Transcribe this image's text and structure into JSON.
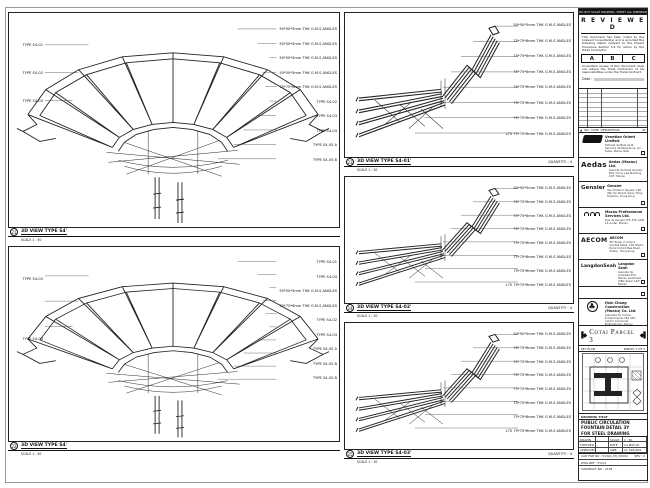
{
  "panels": {
    "tl": {
      "num": "21",
      "title": "3D VIEW TYPE S4'",
      "scale": "SCALE 1 : 50",
      "left_labels": [
        "TYPE S4-01",
        "TYPE S4-02",
        "TYPE S4-03"
      ],
      "right_labels": [
        "50*50*5mm THK G.M.S ANGLES",
        "50*50*5mm THK G.M.S ANGLES",
        "50*50*5mm THK G.M.S ANGLES",
        "50*50*5mm THK G.M.S ANGLES",
        "75*75*6mm THK G.M.S ANGLES",
        "TYPE S4-02",
        "TYPE S4-03",
        "TYPE S4-04",
        "TYPE S4-05 A",
        "TYPE S4-05 B"
      ]
    },
    "bl": {
      "num": "22",
      "title": "3D VIEW TYPE S4'",
      "scale": "SCALE 1 : 50",
      "left_labels": [
        "TYPE S4-02",
        "TYPE S4-03"
      ],
      "right_labels": [
        "TYPE S4-01",
        "TYPE S4-04",
        "50*50*5mm THK G.M.S ANGLES",
        "75*75*6mm THK G.M.S ANGLES",
        "TYPE S4-02",
        "TYPE S4-04",
        "TYPE S4-05 A",
        "TYPE S4-05 B",
        "TYPE S4-05 B"
      ]
    },
    "m1": {
      "num": "23",
      "title": "3D VIEW TYPE S4-01'",
      "scale": "SCALE 1 : 20",
      "quantity": "QUANTITY : 4",
      "right_labels": [
        "50*50*5mm THK G.M.S ANGLES",
        "75*75*6mm THK G.M.S ANGLES",
        "75*75*6mm THK G.M.S ANGLES",
        "75*75*6mm THK G.M.S ANGLES",
        "75*75*6mm THK G.M.S ANGLES",
        "75*75*6mm THK G.M.S ANGLES",
        "75*75*6mm THK G.M.S ANGLES",
        "L75 75*75*6mm THK G.M.S ANGLES"
      ]
    },
    "m2": {
      "num": "24",
      "title": "3D VIEW TYPE S4-02'",
      "scale": "SCALE 1 : 20",
      "quantity": "QUANTITY : 4",
      "right_labels": [
        "50*50*5mm THK G.M.S ANGLES",
        "75*75*6mm THK G.M.S ANGLES",
        "75*75*6mm THK G.M.S ANGLES",
        "75*75*6mm THK G.M.S ANGLES",
        "75*75*6mm THK G.M.S ANGLES",
        "75*75*6mm THK G.M.S ANGLES",
        "75*75*6mm THK G.M.S ANGLES",
        "L75 75*75*6mm THK G.M.S ANGLES"
      ]
    },
    "m3": {
      "num": "25",
      "title": "3D VIEW TYPE S4-03'",
      "scale": "SCALE 1 : 20",
      "quantity": "QUANTITY : 4",
      "right_labels": [
        "50*50*5mm THK G.M.S ANGLES",
        "75*75*6mm THK G.M.S ANGLES",
        "75*75*6mm THK G.M.S ANGLES",
        "75*75*6mm THK G.M.S ANGLES",
        "75*75*6mm THK G.M.S ANGLES",
        "75*75*6mm THK G.M.S ANGLES",
        "75*75*6mm THK G.M.S ANGLES",
        "L75 75*75*6mm THK G.M.S ANGLES"
      ]
    }
  },
  "titleblock": {
    "top_note": "DO NOT SCALE DRAWING. VERIFY ALL DIMENSIONS ON SITE.",
    "reviewed": {
      "title": "R E V I E W E D",
      "para1": "This document has been noted by the relevant Consultant(s) and is accorded the following status relevant to the Project Procedure Section 5.4 for action by the Trade Contractor.",
      "cols": [
        "A",
        "B",
        "C"
      ],
      "para2": "Consultant review of this document does not relieve the Trade Contractor of his responsibilities under the Trade Contract.",
      "date_label": "Date :"
    },
    "revision": {
      "headers": [
        "NO.",
        "DATE",
        "DESCRIPTION",
        "BY"
      ]
    },
    "companies": [
      {
        "name": "Venetian Orient Limited",
        "lines": "Estrada da Baia de N. Senhora da Esperanca, s/n, Taipa, Macau SAR"
      },
      {
        "logo": "Aedas",
        "name": "Aedas (Macau) Ltd.",
        "lines": "Avenida da Praia Grande 409, China Law Building 21/F, Macau"
      },
      {
        "logo": "Gensler",
        "name": "Gensler",
        "lines": "Two Harbour Square, 180 Wai Yip Street, Kwun Tong, Kowloon, Hong Kong"
      },
      {
        "name": "Macau Professional Services Ltd.",
        "lines": "Rua de Xangai 175, Edf. ACM 14 Andar, Macau"
      },
      {
        "logo": "AECOM",
        "name": "AECOM",
        "lines": "8/F Tower 2, Grand Central Plaza, 138 Shatin Rural Committee Road, Shatin, Hong Kong"
      },
      {
        "logo": "LangdonSeah",
        "name": "Langdon Seah",
        "lines": "Avenida da Amizade 555, Macau Landmark ICBC Tower 12/F, Macau"
      }
    ],
    "contractor": {
      "name": "Hsin Chong Construction (Macau) Co. Ltd.",
      "lines": "Alameda Dr. Carlos D'Assumpcao 181-187, Centro Comercial Brilhantismo, Macau"
    },
    "banner": {
      "text": "Cotai Parcel 3"
    },
    "keyplan": {
      "label": "KEY PLAN",
      "sheet": "PARCEL 1 OF 3"
    },
    "drawing": {
      "title_label": "DRAWING TITLE",
      "title_lines": [
        "PUBLIC CIRCULATION",
        "FOUNTAIN DETAIL 3Y",
        "FOR STEEL DRAWING"
      ],
      "fields": [
        [
          "DRAWN",
          "-",
          "SCALE",
          "1 : 50"
        ],
        [
          "CHECKED",
          "-",
          "DATE",
          "14-MAY-10"
        ],
        [
          "APPROVED",
          "-",
          "SIZE",
          "A1 594x841"
        ]
      ],
      "cad_label": "CAD FILE NO : 513A4_PQ_S5004",
      "rev_label": "REV : 0",
      "dwg_ref": "DWG REF : 3Y/24",
      "contract_no": "CONTRACT NO : 2138"
    }
  }
}
